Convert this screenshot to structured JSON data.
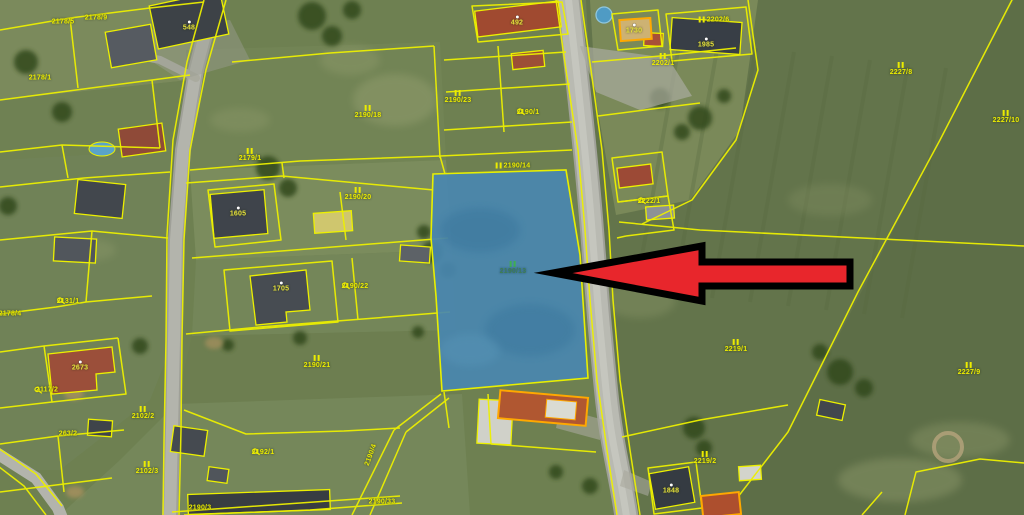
{
  "map": {
    "description": "aerial cadastral map with highlighted parcel and red pointer arrow",
    "colors": {
      "parcel_line": "#edf000",
      "highlight_parcel_fill": "#4987b0",
      "highlight_parcel_stroke": "#e8ef00",
      "building_highlight_stroke": "#ffa800",
      "arrow_fill": "#e8262c",
      "arrow_stroke": "#000000",
      "label_yellow": "#ecec00",
      "label_selected_green": "#3f7d52",
      "road_gray": "#b9bab2",
      "field_green": "#63744b"
    },
    "selected_parcel": {
      "number": "2190/13"
    },
    "annotation": {
      "type": "arrow",
      "direction": "left",
      "points_to": "2190/13"
    },
    "labels": [
      {
        "text": "2178/5",
        "x": 63,
        "y": 22
      },
      {
        "text": "2178/9",
        "x": 96,
        "y": 18
      },
      {
        "text": "2178/1",
        "x": 40,
        "y": 78
      },
      {
        "text": "548",
        "x": 189,
        "y": 26,
        "kind": "building"
      },
      {
        "text": "2179/1",
        "x": 250,
        "y": 155,
        "sym": "II"
      },
      {
        "text": "492",
        "x": 517,
        "y": 21,
        "kind": "building"
      },
      {
        "text": "1730",
        "x": 634,
        "y": 29,
        "kind": "building"
      },
      {
        "text": "1985",
        "x": 706,
        "y": 43,
        "kind": "building"
      },
      {
        "text": "2202/6",
        "x": 714,
        "y": 20,
        "sym": "II",
        "symPos": "left"
      },
      {
        "text": "2202/1",
        "x": 663,
        "y": 60,
        "sym": "II"
      },
      {
        "text": "2227/8",
        "x": 901,
        "y": 69,
        "sym": "II"
      },
      {
        "text": "2227/10",
        "x": 1006,
        "y": 117,
        "sym": "II"
      },
      {
        "text": "2222/1",
        "x": 649,
        "y": 201,
        "sym": "Q"
      },
      {
        "text": "2190/23",
        "x": 458,
        "y": 97,
        "sym": "II"
      },
      {
        "text": "2190/1",
        "x": 528,
        "y": 112,
        "sym": "Q"
      },
      {
        "text": "2190/18",
        "x": 368,
        "y": 112,
        "sym": "II"
      },
      {
        "text": "2190/14",
        "x": 513,
        "y": 166,
        "sym": "II",
        "symPos": "left"
      },
      {
        "text": "2190/13",
        "x": 513,
        "y": 268,
        "sym": "II",
        "kind": "selected"
      },
      {
        "text": "2190/20",
        "x": 358,
        "y": 194,
        "sym": "II"
      },
      {
        "text": "1605",
        "x": 238,
        "y": 212,
        "kind": "building"
      },
      {
        "text": "2190/22",
        "x": 355,
        "y": 286,
        "sym": "Q"
      },
      {
        "text": "1705",
        "x": 281,
        "y": 287,
        "kind": "building"
      },
      {
        "text": "2131/1",
        "x": 68,
        "y": 301,
        "sym": "Q"
      },
      {
        "text": "2178/4",
        "x": 10,
        "y": 314
      },
      {
        "text": "2673",
        "x": 80,
        "y": 366,
        "kind": "building"
      },
      {
        "text": "2117/2",
        "x": 46,
        "y": 390,
        "sym": "Q",
        "symPos": "left"
      },
      {
        "text": "2102/2",
        "x": 143,
        "y": 413,
        "sym": "II"
      },
      {
        "text": "263/2",
        "x": 68,
        "y": 434
      },
      {
        "text": "2102/3",
        "x": 147,
        "y": 468,
        "sym": "II"
      },
      {
        "text": "2190/21",
        "x": 317,
        "y": 362,
        "sym": "II"
      },
      {
        "text": "2192/1",
        "x": 263,
        "y": 452,
        "sym": "Q"
      },
      {
        "text": "2190/4",
        "x": 371,
        "y": 455,
        "rotate": -70
      },
      {
        "text": "2190/33",
        "x": 382,
        "y": 502
      },
      {
        "text": "2190/3",
        "x": 200,
        "y": 508
      },
      {
        "text": "2219/1",
        "x": 736,
        "y": 346,
        "sym": "II"
      },
      {
        "text": "2219/2",
        "x": 705,
        "y": 458,
        "sym": "II"
      },
      {
        "text": "2227/9",
        "x": 969,
        "y": 369,
        "sym": "II"
      },
      {
        "text": "1848",
        "x": 671,
        "y": 489,
        "kind": "building"
      }
    ]
  }
}
